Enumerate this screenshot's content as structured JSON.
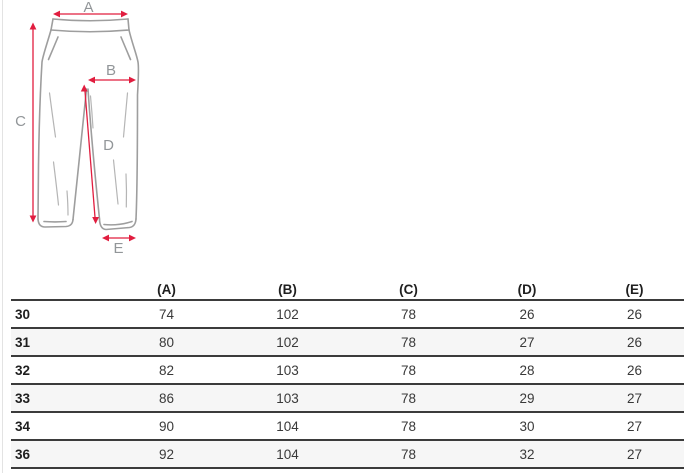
{
  "diagram": {
    "type": "pants-measurement-diagram",
    "labels": {
      "A": "A",
      "B": "B",
      "C": "C",
      "D": "D",
      "E": "E"
    },
    "colors": {
      "dimension_arrows": "#e11d3f",
      "dimension_labels": "#929699",
      "garment_outline": "#9e9e9e"
    }
  },
  "table": {
    "columns": [
      "(A)",
      "(B)",
      "(C)",
      "(D)",
      "(E)"
    ],
    "rows": [
      {
        "size": "30",
        "values": [
          "74",
          "102",
          "78",
          "26",
          "26"
        ]
      },
      {
        "size": "31",
        "values": [
          "80",
          "102",
          "78",
          "27",
          "26"
        ]
      },
      {
        "size": "32",
        "values": [
          "82",
          "103",
          "78",
          "28",
          "26"
        ]
      },
      {
        "size": "33",
        "values": [
          "86",
          "103",
          "78",
          "29",
          "27"
        ]
      },
      {
        "size": "34",
        "values": [
          "90",
          "104",
          "78",
          "30",
          "27"
        ]
      },
      {
        "size": "36",
        "values": [
          "92",
          "104",
          "78",
          "32",
          "27"
        ]
      }
    ],
    "stripe_color": "#f6f6f6",
    "row_border_color": "#3b3b3b"
  }
}
